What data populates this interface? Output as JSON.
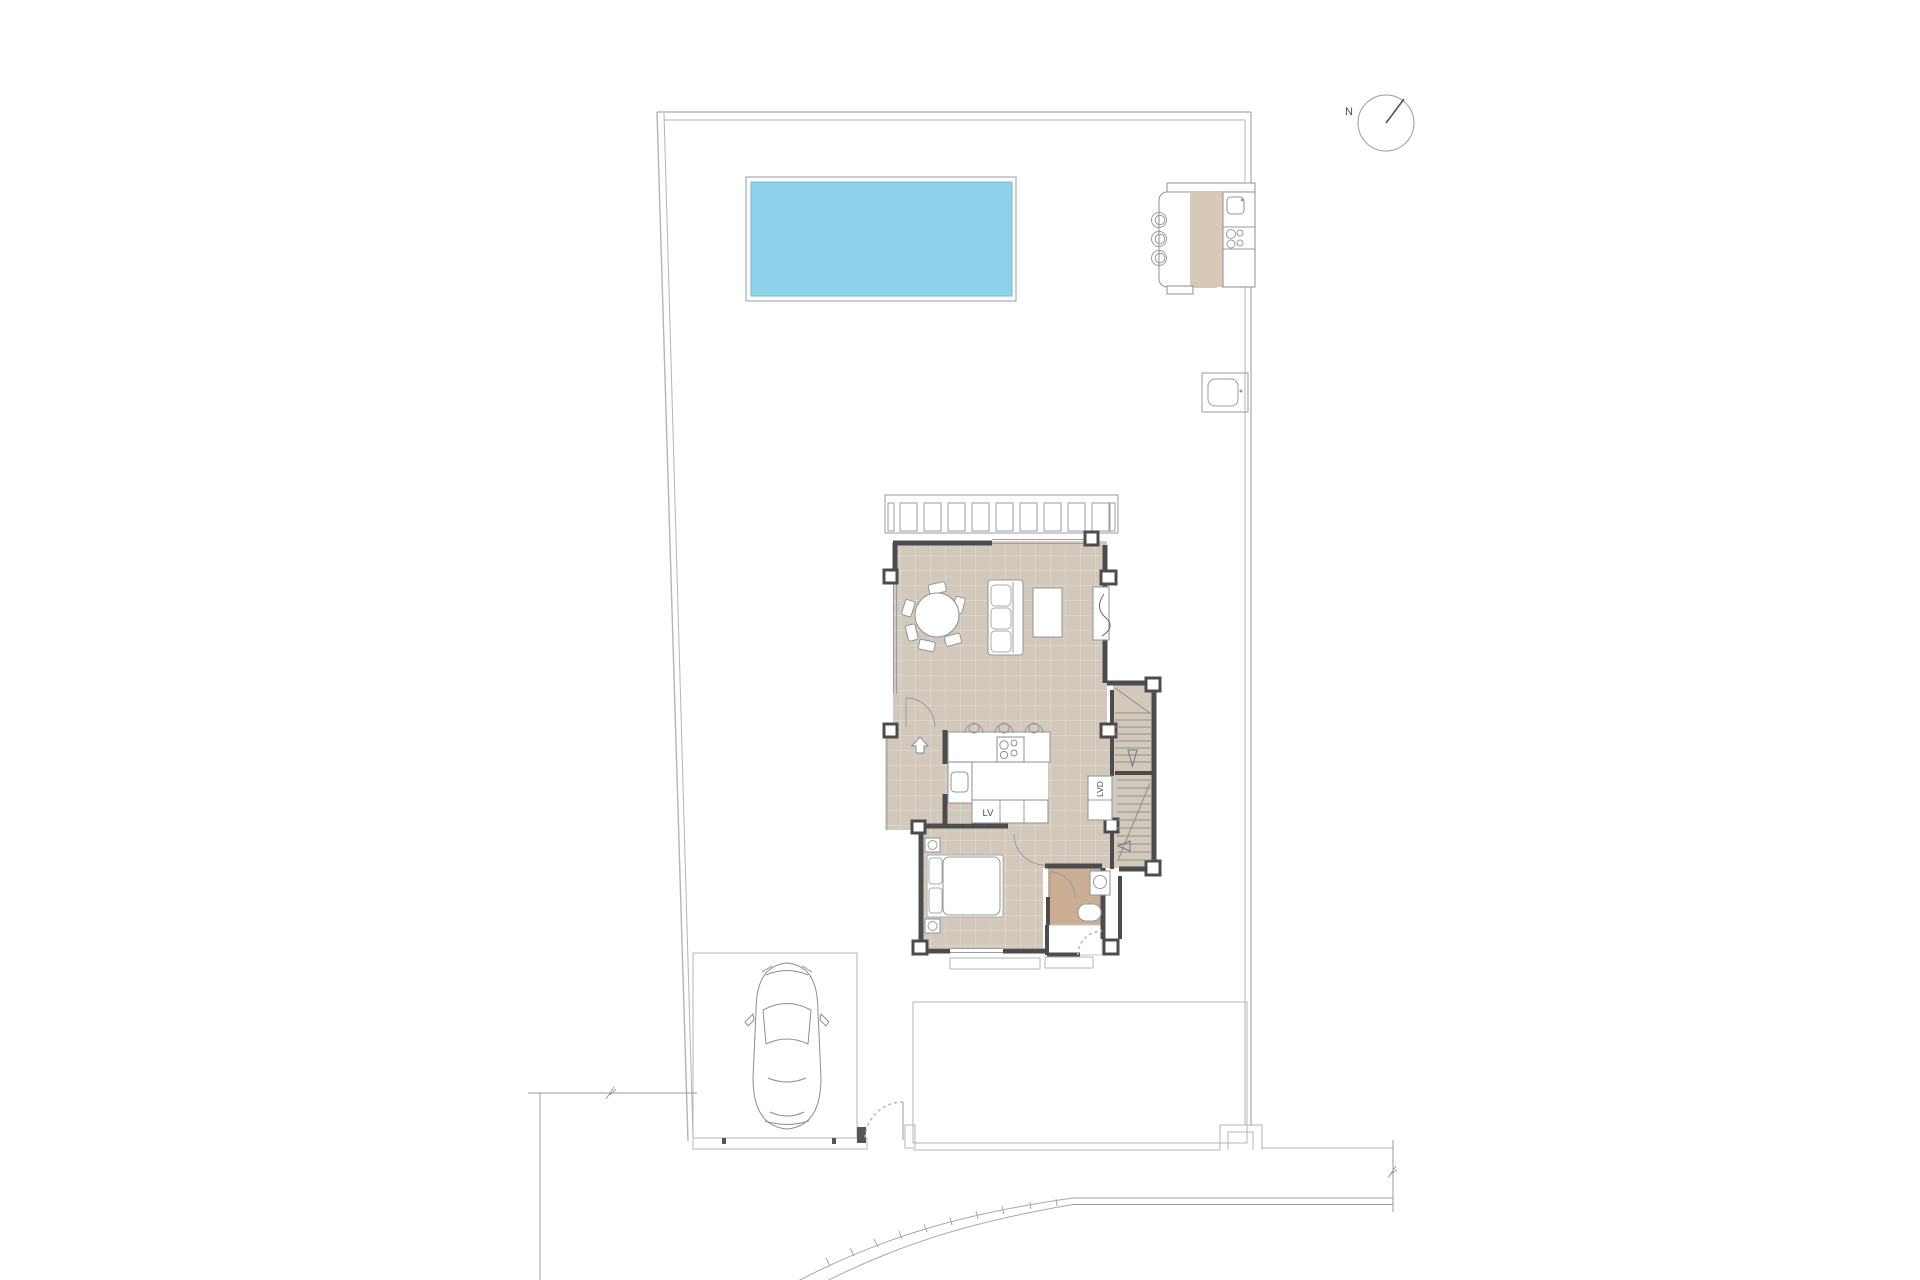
{
  "plan": {
    "labels": {
      "north_letter": "N",
      "dishwasher": "LV",
      "washer_closet": "LVD"
    },
    "colors": {
      "pool_water": "#8ED1EB",
      "floor_taupe": "#D2C8BC",
      "bath_tan": "#C9AE93",
      "kitchen_beige": "#D6C9B6",
      "wall_dark": "#4C4C4C"
    }
  }
}
